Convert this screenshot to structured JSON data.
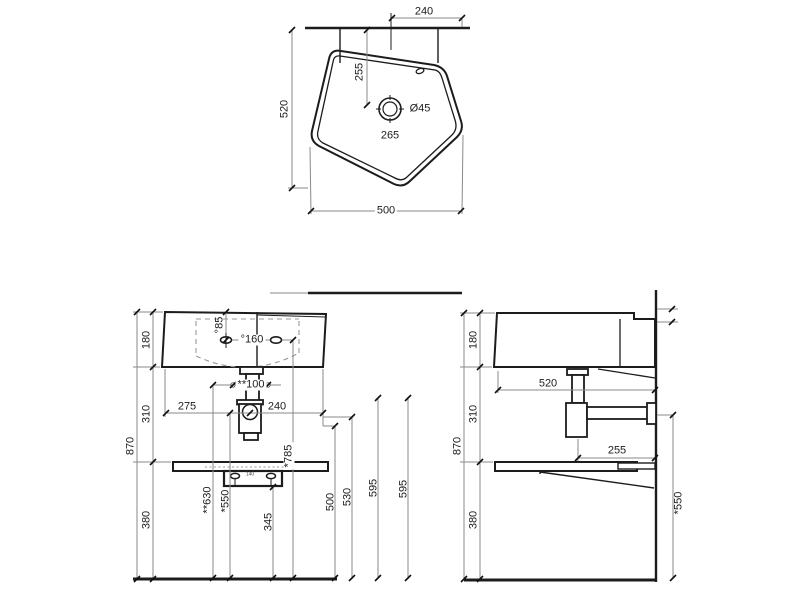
{
  "drawing_labels": {
    "top_view": {
      "wall_to_edge": "240",
      "height": "520",
      "width": "500",
      "drain_from_wall": "255",
      "drain_diameter": "Ø45",
      "drain_to_front": "265"
    },
    "front_view": {
      "basin_height": "180",
      "mid_height": "310",
      "total_height": "870",
      "under_shelf_height": "380",
      "tap_hole_offset": "°85",
      "tap_hole_spacing": "°160",
      "waste_pipe_dim": "**100",
      "left_to_trap": "275",
      "trap_to_right": "240",
      "bracket_hole_spacing": "140",
      "waste_height": "**630",
      "trap_outlet_height": "*550",
      "tap_height": "*785",
      "bracket_height": "345",
      "h500": "500",
      "h530": "530",
      "h595_a": "595",
      "h595_b": "595"
    },
    "side_view": {
      "basin_height": "180",
      "mid_height": "310",
      "total_height": "870",
      "under_shelf_height": "380",
      "depth": "520",
      "trap_to_wall": "255",
      "outlet_height": "*550"
    }
  }
}
